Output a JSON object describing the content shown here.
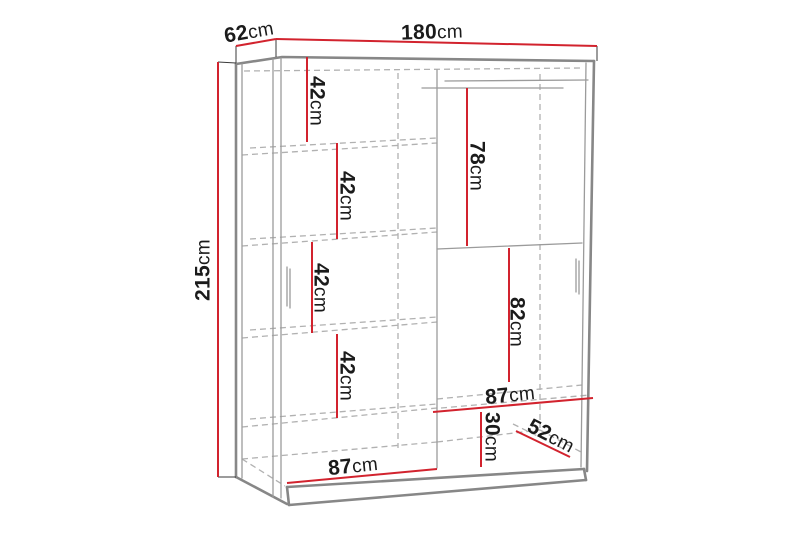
{
  "diagram": {
    "unit": "cm",
    "colors": {
      "dimension": "#d2232e",
      "structure": "#878787",
      "hidden": "#b1b1b1",
      "text": "#1b1b1b"
    },
    "dimensions": {
      "depth_top": {
        "value": "62",
        "unit": "cm"
      },
      "width_top": {
        "value": "180",
        "unit": "cm"
      },
      "height_left": {
        "value": "215",
        "unit": "cm"
      },
      "shelf_gap_1": {
        "value": "42",
        "unit": "cm"
      },
      "shelf_gap_2": {
        "value": "42",
        "unit": "cm"
      },
      "shelf_gap_3": {
        "value": "42",
        "unit": "cm"
      },
      "shelf_gap_4": {
        "value": "42",
        "unit": "cm"
      },
      "hanging_space_top": {
        "value": "78",
        "unit": "cm"
      },
      "hanging_space_low": {
        "value": "82",
        "unit": "cm"
      },
      "right_shelf_width": {
        "value": "87",
        "unit": "cm"
      },
      "bottom_shelf_height": {
        "value": "30",
        "unit": "cm"
      },
      "bottom_shelf_depth": {
        "value": "52",
        "unit": "cm"
      },
      "left_section_width": {
        "value": "87",
        "unit": "cm"
      }
    }
  }
}
